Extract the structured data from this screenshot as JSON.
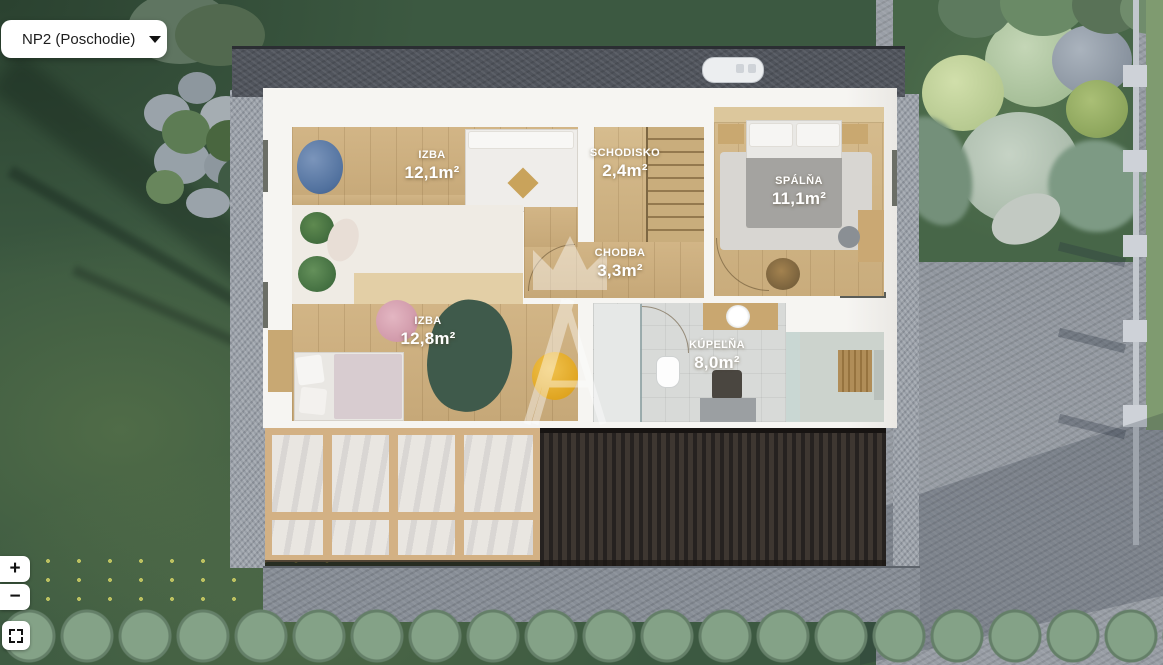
{
  "floor_selector": {
    "value": "NP2 (Poschodie)"
  },
  "controls": {
    "zoom_in": "+",
    "zoom_out": "−"
  },
  "icons": {
    "dropdown_caret": "caret-down",
    "fullscreen": "expand-corners"
  },
  "watermark": {
    "letter": "A",
    "shape": "crown"
  },
  "rooms": [
    {
      "id": "izba-1",
      "name": "IZBA",
      "area": "12,1m²"
    },
    {
      "id": "schodisko",
      "name": "SCHODISKO",
      "area": "2,4m²"
    },
    {
      "id": "spalna",
      "name": "SPÁLŇA",
      "area": "11,1m²"
    },
    {
      "id": "chodba",
      "name": "CHODBA",
      "area": "3,3m²"
    },
    {
      "id": "izba-2",
      "name": "IZBA",
      "area": "12,8m²"
    },
    {
      "id": "kupelna",
      "name": "KÚPEĽŇA",
      "area": "8,0m²"
    }
  ],
  "colors": {
    "ui_button_bg": "#ffffff",
    "ui_text": "#1d1d1d",
    "grass": "#3c5941",
    "wood_floor": "#ccb083",
    "roof_dark": "#322c28",
    "roof_gravel": "#50545c",
    "pavement": "#8f959d",
    "label_text": "#ffffff",
    "rug_green": "#3f5a4b",
    "pouf_yellow": "#e7af2f",
    "beanbag_blue": "#5f7fa8"
  }
}
